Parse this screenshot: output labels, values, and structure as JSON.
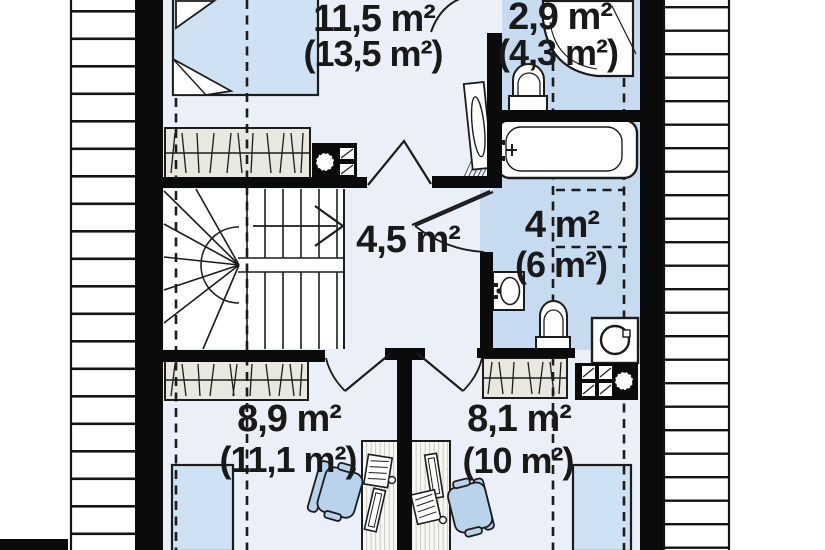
{
  "plan": {
    "type": "attic-floor-plan",
    "rooms": [
      {
        "name": "bedroom",
        "area": "11,5 m²",
        "area_full": "(13,5 m²)"
      },
      {
        "name": "bathroom-small",
        "area": "2,9 m²",
        "area_full": "(4,3 m²)"
      },
      {
        "name": "hall-stairs",
        "area": "4,5 m²",
        "area_full": ""
      },
      {
        "name": "bathroom-main",
        "area": "4 m²",
        "area_full": "(6 m²)"
      },
      {
        "name": "room-left",
        "area": "8,9 m²",
        "area_full": "(11,1 m²)"
      },
      {
        "name": "room-right",
        "area": "8,1 m²",
        "area_full": "(10 m²)"
      }
    ],
    "symbols": [
      "double-bed",
      "single-bed",
      "wardrobe",
      "u-shaped-stairs",
      "bathtub",
      "shower-cabin",
      "toilet",
      "washbasin",
      "washing-machine",
      "chimney-vent-block",
      "desk",
      "office-chair",
      "roof-slope-hatch",
      "door-swing",
      "ceiling-height-dashed-line"
    ],
    "colors": {
      "wall": "#0b0b0b",
      "floor": "#ebf0f8",
      "wet_floor": "#c6daf0",
      "furniture_blue": "#cfe2f4",
      "chair_blue": "#b9d3ec",
      "wardrobe": "#e8e8e1",
      "label": "#191919",
      "outline": "#1c1c1c",
      "background": "#ffffff"
    }
  }
}
